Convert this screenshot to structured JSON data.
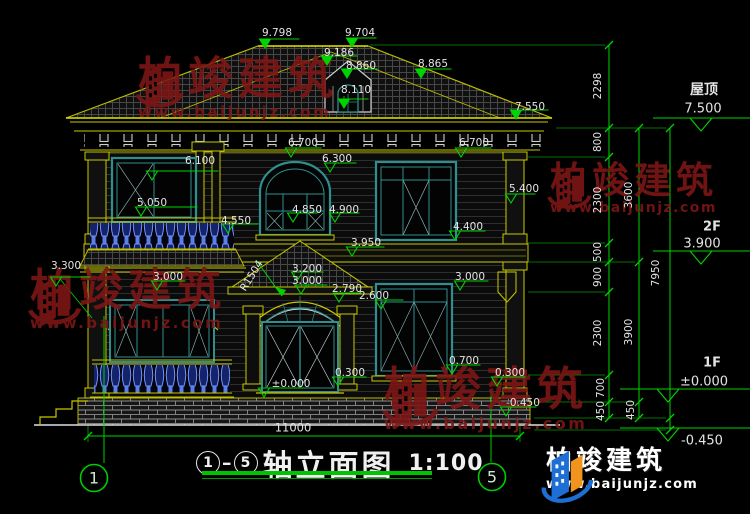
{
  "title": {
    "axis_start": "1",
    "dash": "–",
    "axis_end": "5",
    "name": "轴立面图",
    "scale": "1:100"
  },
  "axes": {
    "left": "1",
    "right": "5"
  },
  "watermark": {
    "brand": "柏竣建筑",
    "url": "www.baijunjz.com"
  },
  "logo": {
    "brand": "柏竣建筑",
    "url": "www.baijunjz.com"
  },
  "colors": {
    "green": "#00d400",
    "dimgreen": "#009900",
    "yellow": "#c8c800",
    "teal": "#2f8f8f",
    "red": "#7d1616",
    "white": "#e8e8e8",
    "blue": "#1d6fd6",
    "orange": "#f0941e"
  },
  "dims": [
    {
      "t": "9.798",
      "x": 277,
      "y": 33
    },
    {
      "t": "9.704",
      "x": 360,
      "y": 33
    },
    {
      "t": "9.186",
      "x": 339,
      "y": 53
    },
    {
      "t": "8.860",
      "x": 361,
      "y": 66
    },
    {
      "t": "8.865",
      "x": 433,
      "y": 64
    },
    {
      "t": "8.110",
      "x": 356,
      "y": 90
    },
    {
      "t": "7.550",
      "x": 530,
      "y": 107
    },
    {
      "t": "6.700",
      "x": 303,
      "y": 143
    },
    {
      "t": "6.700",
      "x": 474,
      "y": 143
    },
    {
      "t": "6.300",
      "x": 337,
      "y": 159
    },
    {
      "t": "6.100",
      "x": 200,
      "y": 161
    },
    {
      "t": "5.400",
      "x": 524,
      "y": 189
    },
    {
      "t": "5.050",
      "x": 152,
      "y": 203
    },
    {
      "t": "4.850",
      "x": 307,
      "y": 210
    },
    {
      "t": "4.900",
      "x": 344,
      "y": 210
    },
    {
      "t": "4.550",
      "x": 236,
      "y": 221
    },
    {
      "t": "4.400",
      "x": 468,
      "y": 227
    },
    {
      "t": "3.950",
      "x": 366,
      "y": 243
    },
    {
      "t": "3.300",
      "x": 66,
      "y": 266
    },
    {
      "t": "3.000",
      "x": 168,
      "y": 277
    },
    {
      "t": "3.200",
      "x": 307,
      "y": 269
    },
    {
      "t": "3.000",
      "x": 307,
      "y": 281
    },
    {
      "t": "3.000",
      "x": 470,
      "y": 277
    },
    {
      "t": "2.790",
      "x": 347,
      "y": 289
    },
    {
      "t": "2.600",
      "x": 374,
      "y": 296
    },
    {
      "t": "R1504",
      "x": 252,
      "y": 276,
      "rot": -58
    },
    {
      "t": "±0.000",
      "x": 291,
      "y": 384
    },
    {
      "t": "0.300",
      "x": 350,
      "y": 373
    },
    {
      "t": "0.700",
      "x": 464,
      "y": 361
    },
    {
      "t": "0.300",
      "x": 510,
      "y": 373
    },
    {
      "t": "-0.450",
      "x": 523,
      "y": 403
    },
    {
      "t": "11000",
      "x": 293,
      "y": 428,
      "fs": 11.5
    },
    {
      "t": "屋顶",
      "x": 704,
      "y": 90,
      "fs": 14,
      "b": true
    },
    {
      "t": "7.500",
      "x": 703,
      "y": 109,
      "fs": 13
    },
    {
      "t": "2F",
      "x": 712,
      "y": 227,
      "fs": 13,
      "b": true
    },
    {
      "t": "3.900",
      "x": 702,
      "y": 244,
      "fs": 13
    },
    {
      "t": "1F",
      "x": 712,
      "y": 363,
      "fs": 13,
      "b": true
    },
    {
      "t": "±0.000",
      "x": 704,
      "y": 382,
      "fs": 13
    },
    {
      "t": "-0.450",
      "x": 702,
      "y": 441,
      "fs": 13
    },
    {
      "t": "2298",
      "x": 598,
      "y": 86,
      "rot": -90
    },
    {
      "t": "800",
      "x": 598,
      "y": 142,
      "rot": -90
    },
    {
      "t": "2300",
      "x": 598,
      "y": 200,
      "rot": -90
    },
    {
      "t": "500",
      "x": 598,
      "y": 252,
      "rot": -90
    },
    {
      "t": "900",
      "x": 598,
      "y": 277,
      "rot": -90
    },
    {
      "t": "2300",
      "x": 598,
      "y": 333,
      "rot": -90
    },
    {
      "t": "700",
      "x": 601,
      "y": 388,
      "rot": -90
    },
    {
      "t": "450",
      "x": 601,
      "y": 411,
      "rot": -90
    },
    {
      "t": "3600",
      "x": 629,
      "y": 195,
      "rot": -90
    },
    {
      "t": "3900",
      "x": 629,
      "y": 332,
      "rot": -90
    },
    {
      "t": "450",
      "x": 631,
      "y": 410,
      "rot": -90
    },
    {
      "t": "7950",
      "x": 656,
      "y": 273,
      "rot": -90
    }
  ],
  "markers": [
    {
      "x": 265,
      "y": 48,
      "k": "s",
      "ul": 40
    },
    {
      "x": 352,
      "y": 47,
      "k": "s",
      "ul": 30
    },
    {
      "x": 327,
      "y": 65,
      "k": "s",
      "ul": 36
    },
    {
      "x": 347,
      "y": 78,
      "k": "s",
      "ul": 36
    },
    {
      "x": 421,
      "y": 78,
      "k": "s",
      "ul": 36
    },
    {
      "x": 344,
      "y": 108,
      "k": "s",
      "ul": 30
    },
    {
      "x": 516,
      "y": 119,
      "k": "s",
      "ul": 38
    },
    {
      "x": 291,
      "y": 157,
      "k": "o",
      "ul": 36
    },
    {
      "x": 461,
      "y": 157,
      "k": "o",
      "ul": 36
    },
    {
      "x": 330,
      "y": 172,
      "k": "o",
      "ul": 32
    },
    {
      "x": 152,
      "y": 180,
      "k": "o",
      "ul": 72
    },
    {
      "x": 511,
      "y": 203,
      "k": "o",
      "ul": 30
    },
    {
      "x": 141,
      "y": 216,
      "k": "o",
      "ul": 62
    },
    {
      "x": 293,
      "y": 222,
      "k": "o",
      "ul": 30
    },
    {
      "x": 335,
      "y": 222,
      "k": "o",
      "ul": 30
    },
    {
      "x": 228,
      "y": 233,
      "k": "o",
      "ul": 36
    },
    {
      "x": 455,
      "y": 240,
      "k": "o",
      "ul": 36
    },
    {
      "x": 352,
      "y": 256,
      "k": "o",
      "ul": 38
    },
    {
      "x": 56,
      "y": 286,
      "k": "o",
      "ul": 40
    },
    {
      "x": 157,
      "y": 290,
      "k": "o",
      "ul": 34
    },
    {
      "x": 297,
      "y": 281,
      "k": "o",
      "ul": 32
    },
    {
      "x": 301,
      "y": 294,
      "k": "o",
      "ul": 32
    },
    {
      "x": 460,
      "y": 290,
      "k": "o",
      "ul": 34
    },
    {
      "x": 339,
      "y": 302,
      "k": "o",
      "ul": 28
    },
    {
      "x": 381,
      "y": 309,
      "k": "o",
      "ul": 28
    },
    {
      "x": 264,
      "y": 397,
      "k": "o",
      "ul": 46
    },
    {
      "x": 338,
      "y": 386,
      "k": "o",
      "ul": 34
    },
    {
      "x": 452,
      "y": 374,
      "k": "o",
      "ul": 34
    },
    {
      "x": 497,
      "y": 386,
      "k": "o",
      "ul": 34
    },
    {
      "x": 506,
      "y": 416,
      "k": "o",
      "ul": 36
    },
    {
      "x": 701,
      "y": 131,
      "k": "O"
    },
    {
      "x": 701,
      "y": 264,
      "k": "O"
    },
    {
      "x": 668,
      "y": 402,
      "k": "O"
    },
    {
      "x": 668,
      "y": 441,
      "k": "O"
    }
  ]
}
